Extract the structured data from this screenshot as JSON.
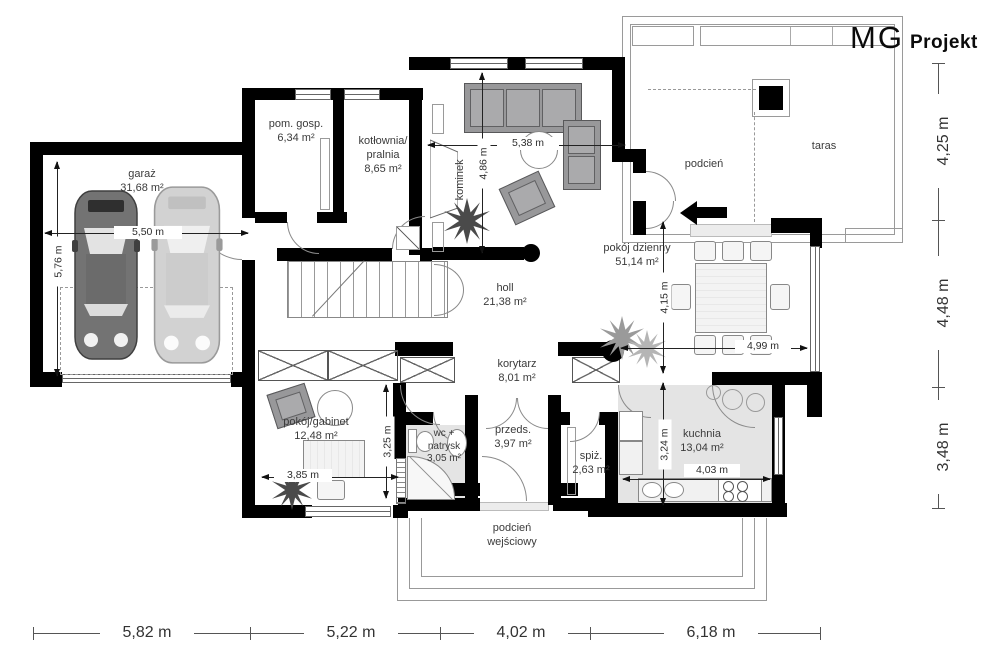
{
  "brand": {
    "mg": "MG",
    "projekt": "Projekt"
  },
  "rooms": {
    "garaz": {
      "name": "garaż",
      "area": "31,68 m²"
    },
    "pom_gosp": {
      "name": "pom. gosp.",
      "area": "6,34 m²"
    },
    "kotlownia": {
      "line1": "kotłownia/",
      "line2": "pralnia",
      "area": "8,65 m²"
    },
    "kominek": {
      "name": "kominek"
    },
    "pokoj_dzienny": {
      "name": "pokój dzienny",
      "area": "51,14 m²"
    },
    "podcien": {
      "name": "podcień"
    },
    "taras": {
      "name": "taras"
    },
    "holl": {
      "name": "holl",
      "area": "21,38 m²"
    },
    "korytarz": {
      "name": "korytarz",
      "area": "8,01 m²"
    },
    "gabinet": {
      "name": "pokój/gabinet",
      "area": "12,48 m²"
    },
    "wc": {
      "line1": "wc +",
      "line2": "natrysk",
      "area": "3,05 m²"
    },
    "przeds": {
      "name": "przeds.",
      "area": "3,97 m²"
    },
    "spiz": {
      "name": "spiż.",
      "area": "2,63 m²"
    },
    "kuchnia": {
      "name": "kuchnia",
      "area": "13,04 m²"
    },
    "podcien_wejsciowy": {
      "line1": "podcień",
      "line2": "wejściowy"
    }
  },
  "dimensions": {
    "bottom": [
      "5,82 m",
      "5,22 m",
      "4,02 m",
      "6,18 m"
    ],
    "right": [
      "4,25 m",
      "4,48 m",
      "3,48 m"
    ],
    "garage_width": "5,50 m",
    "garage_depth": "5,76 m",
    "living_width": "5,38 m",
    "living_depth": "4,86 m",
    "dining_depth": "4,15 m",
    "dining_width": "4,99 m",
    "gabinet_width": "3,85 m",
    "gabinet_depth": "3,25 m",
    "kitchen_depth": "3,24 m",
    "kitchen_width": "4,03 m"
  },
  "colors": {
    "wall": "#000000",
    "floor_gray": "#e4e4e4",
    "line_gray": "#9a9a9a"
  }
}
